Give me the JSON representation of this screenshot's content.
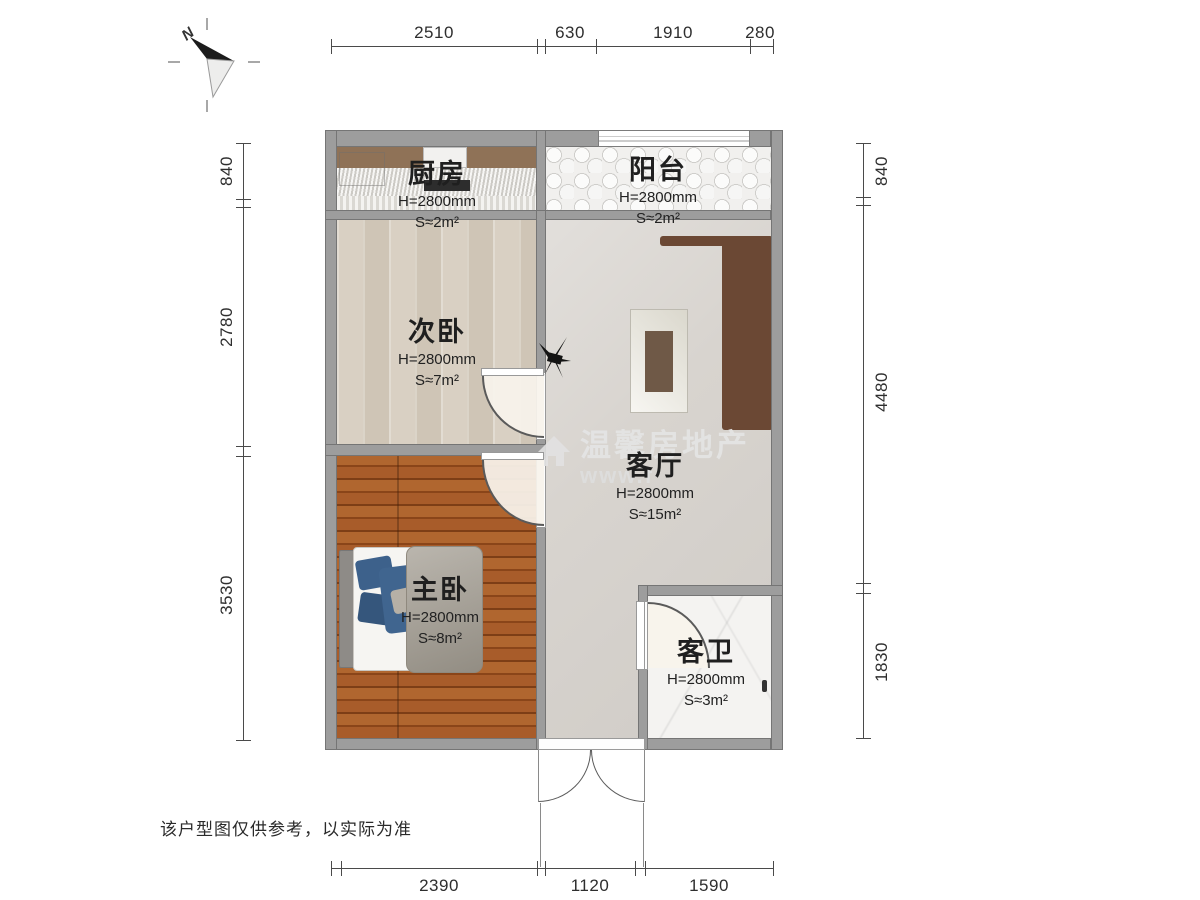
{
  "meta": {
    "north_label": "N",
    "disclaimer": "该户型图仅供参考，以实际为准"
  },
  "watermark": {
    "brand": "温馨房地产",
    "url": "www.f"
  },
  "rooms": [
    {
      "id": "kitchen",
      "name": "厨房",
      "height": "H=2800mm",
      "area": "S≈2m²"
    },
    {
      "id": "balcony",
      "name": "阳台",
      "height": "H=2800mm",
      "area": "S≈2m²"
    },
    {
      "id": "second-bedroom",
      "name": "次卧",
      "height": "H=2800mm",
      "area": "S≈7m²"
    },
    {
      "id": "living-room",
      "name": "客厅",
      "height": "H=2800mm",
      "area": "S≈15m²"
    },
    {
      "id": "master-bedroom",
      "name": "主卧",
      "height": "H=2800mm",
      "area": "S≈8m²"
    },
    {
      "id": "bathroom",
      "name": "客卫",
      "height": "H=2800mm",
      "area": "S≈3m²"
    }
  ],
  "dimensions": {
    "top": [
      "2510",
      "630",
      "1910",
      "280"
    ],
    "bottom": [
      "2390",
      "1120",
      "1590"
    ],
    "left": [
      "840",
      "2780",
      "3530"
    ],
    "right": [
      "840",
      "4480",
      "1830"
    ]
  },
  "colors": {
    "wall": "#9d9d9d",
    "dimension_line": "#4a4a4a",
    "master_floor": "#9c5526",
    "second_floor": "#d8cfc2",
    "living_floor": "#d8d4cf",
    "sofa_frame": "#6b4834",
    "bed_blue": "#3d618b"
  }
}
